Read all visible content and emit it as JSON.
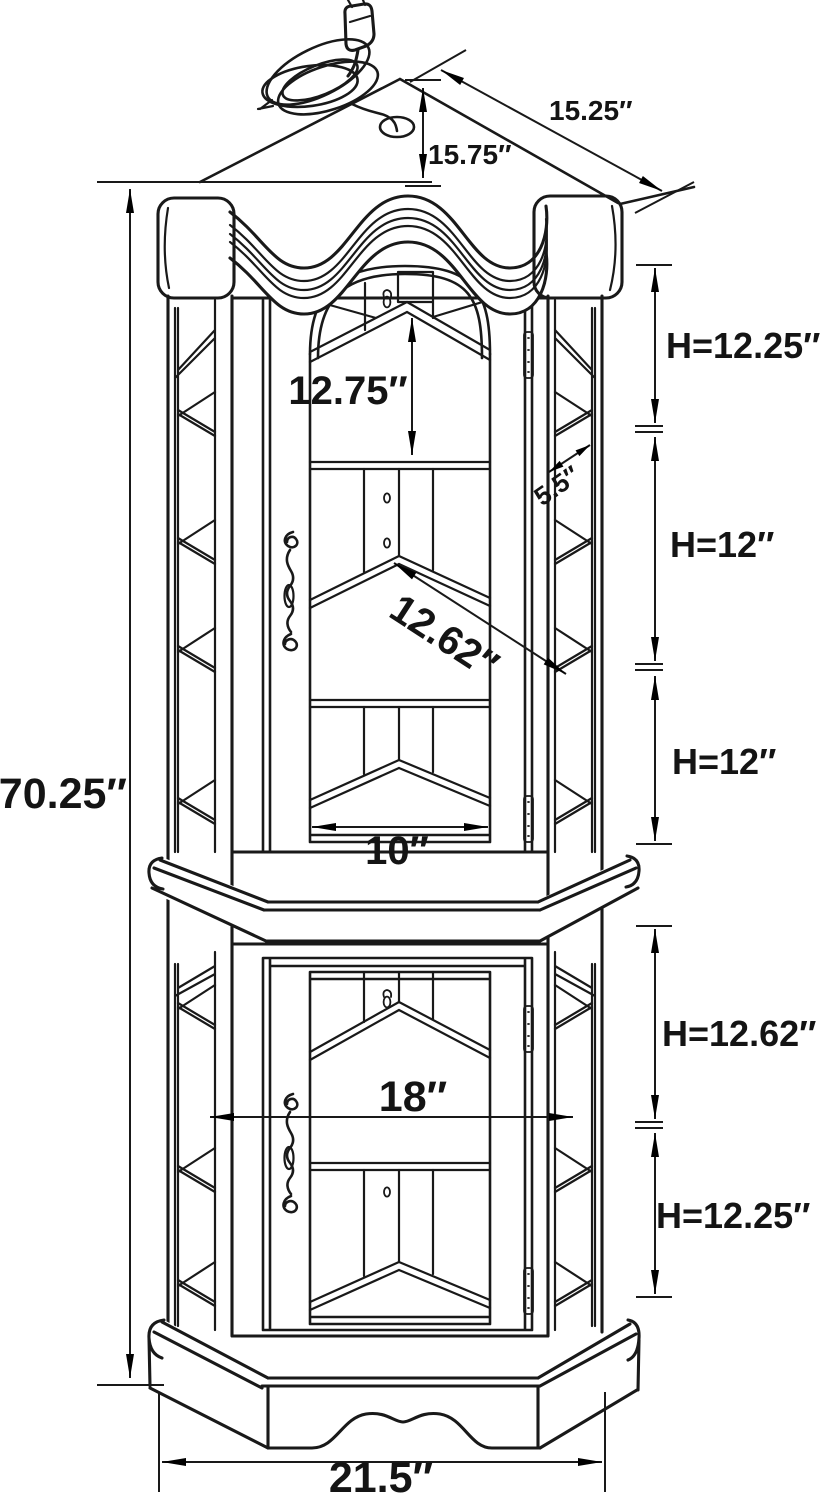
{
  "figure": {
    "type": "technical line drawing",
    "subject": "Corner curio display cabinet with arched crown, two glass doors, interior shelves, and lighting power cord",
    "background_color": "#ffffff",
    "line_color": "#191919"
  },
  "dimensions": {
    "top_back_depth": "15.75″",
    "top_side_edge": "15.25″",
    "upper_opening_height": "12.75″",
    "side_glass_depth": "5.5″",
    "shelf_front_diagonal": "12.62″",
    "upper_back_width": "10″",
    "overall_height": "70.25″",
    "opening1_height": "H=12.25″",
    "opening2_height": "H=12″",
    "opening3_height": "H=12″",
    "opening4_height": "H=12.62″",
    "opening5_height": "H=12.25″",
    "lower_interior_width": "18″",
    "base_width": "21.5″"
  }
}
